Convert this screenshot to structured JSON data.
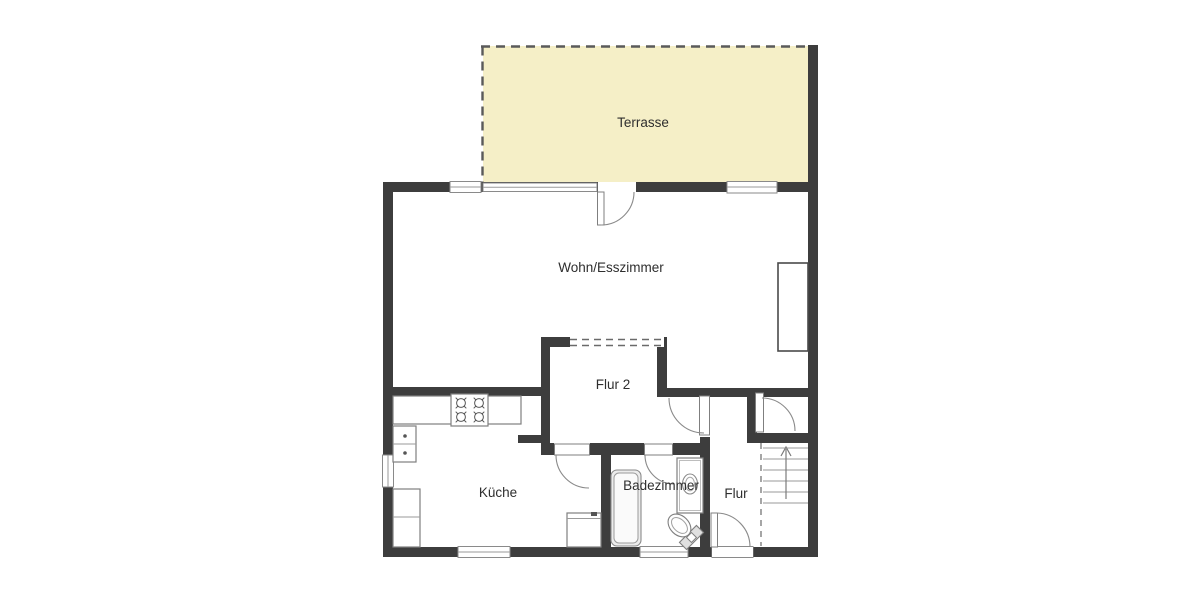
{
  "page": {
    "background": "#ffffff",
    "type": "floor-plan"
  },
  "colors": {
    "wall": "#3d3d3d",
    "terrace_fill": "#f5efc7",
    "fixture_stroke": "#7f7f7f",
    "label_text": "#2e2e2e",
    "dashed_line": "#5a5a5a"
  },
  "rooms": {
    "terrasse": {
      "label": "Terrasse"
    },
    "wohn_esszimmer": {
      "label": "Wohn/Esszimmer"
    },
    "flur_2": {
      "label": "Flur 2"
    },
    "kueche": {
      "label": "Küche"
    },
    "badezimmer": {
      "label": "Badezimmer"
    },
    "flur": {
      "label": "Flur"
    }
  },
  "fixtures": {
    "kitchen": [
      "counter",
      "stove-4-burners",
      "double-sink",
      "appliance",
      "lower-counter"
    ],
    "bathroom": [
      "bathtub",
      "washbasin-vanity",
      "toilet"
    ],
    "stairs": {
      "direction": "up",
      "treads": 6
    },
    "doors": [
      "terrace-door",
      "kitchen-door",
      "bathroom-door",
      "hall-door",
      "stair-door",
      "entrance-door"
    ],
    "windows": 6
  }
}
